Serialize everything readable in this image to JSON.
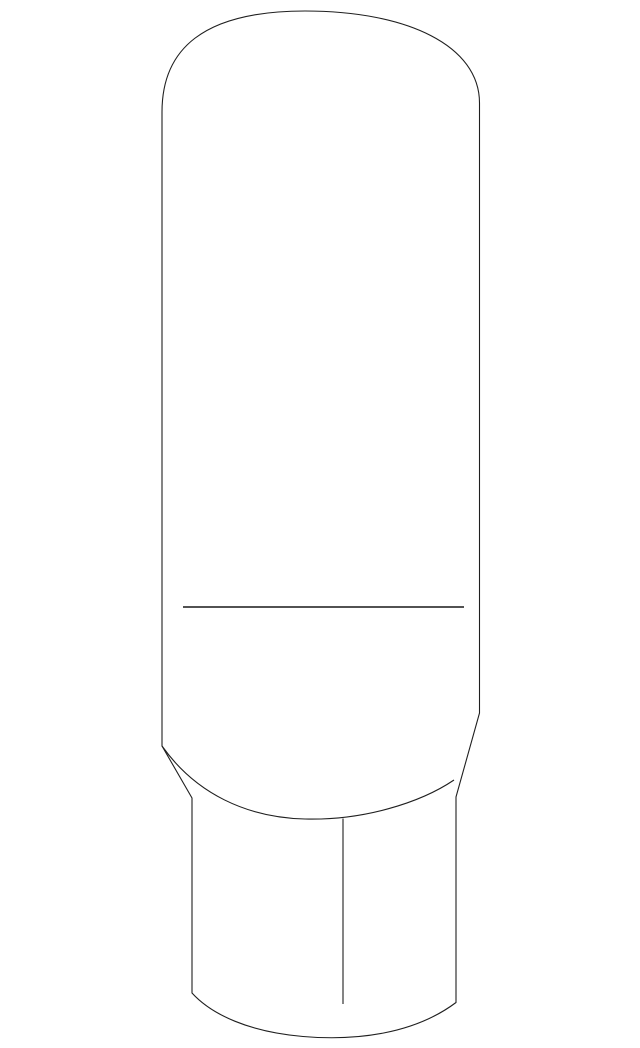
{
  "canvas": {
    "width": 640,
    "height": 1048,
    "background_color": "#ffffff",
    "viewbox": "0 0 640 1048"
  },
  "figure": {
    "name": "part-line-drawing",
    "subject": "capsule-shaped part (bulb/knob) with tapered faceted base, outline illustration",
    "line_color": "#1f1f1f",
    "seam_line_color": "#3a3a3a",
    "fill_color": "#ffffff",
    "paths": {
      "body_outline": "M 162 746 L 162 112 C 162 50 202 11 305 11 C 408 11 479.5 46 479.5 103 L 479.5 713 L 456 797 L 456 1002.5 C 414 1034 356 1041 303 1036.5 C 250 1032 212 1015 192 993 L 192 798 Z",
      "base_rim_arc": "M 162 746 C 196 794 247 817.5 305 819 C 363 820.5 420 803 454 780",
      "base_facet_edge": "M 343 818.5 L 343 1004",
      "body_seam_line": "M 183 607 L 464 607"
    }
  }
}
